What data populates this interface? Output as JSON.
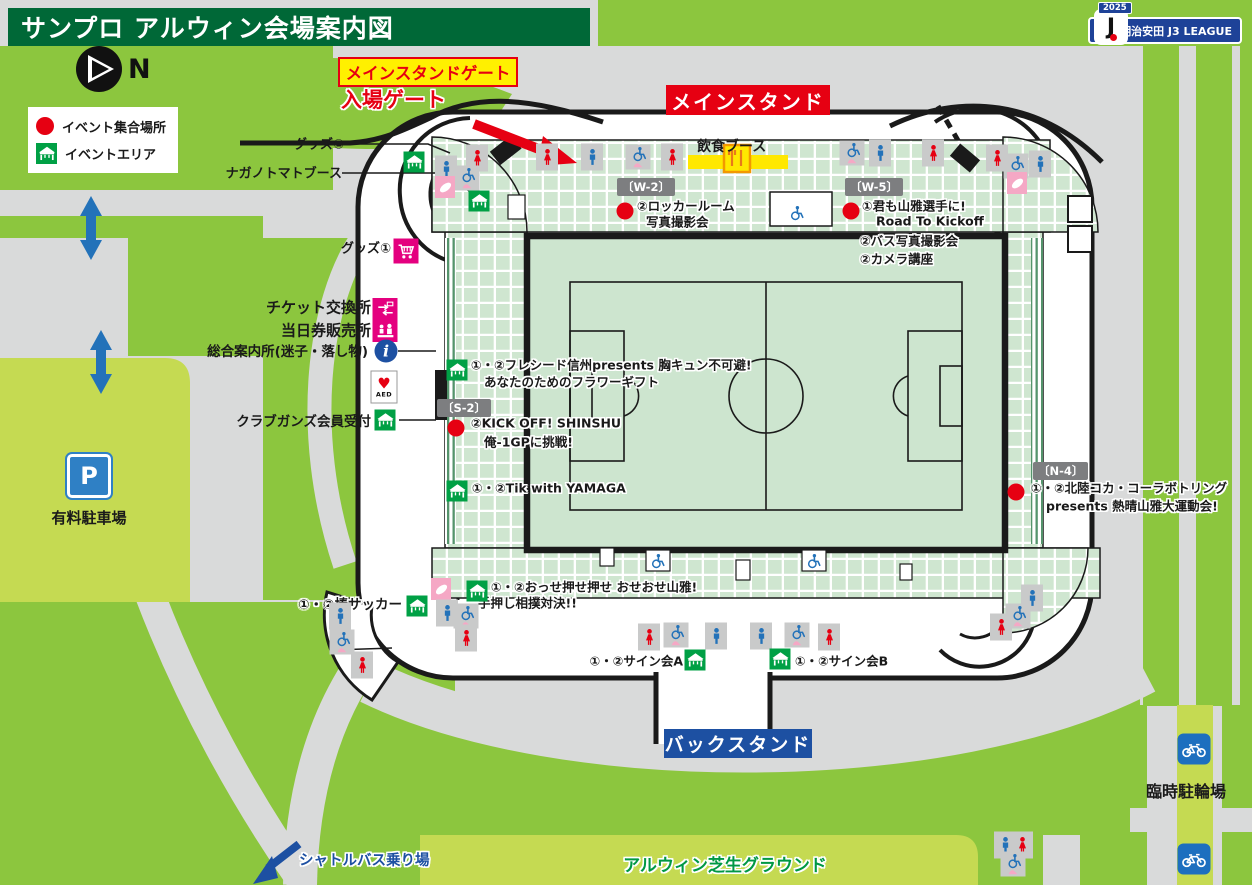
{
  "header": {
    "title": "サンプロ アルウィン会場案内図"
  },
  "league": {
    "year": "2025",
    "name": "明治安田 J3 LEAGUE",
    "crest": "J"
  },
  "compass": {
    "label": "N"
  },
  "legend": {
    "meeting_point": "イベント集合場所",
    "event_area": "イベントエリア"
  },
  "gates": {
    "main_stand_gate": "メインスタンドゲート",
    "entrance_gate": "入場ゲート"
  },
  "stands": {
    "main": "メインスタンド",
    "back": "バックスタンド"
  },
  "food": {
    "label": "飲食ブース"
  },
  "sections": {
    "w2": "〔W-2〕",
    "w5": "〔W-5〕",
    "s2": "〔S-2〕",
    "n4": "〔N-4〕"
  },
  "left_labels": {
    "goods2": "グッズ②",
    "nagano_tomato": "ナガノトマトブース",
    "goods1": "グッズ①",
    "ticket_exchange": "チケット交換所",
    "same_day_tickets": "当日券販売所",
    "info_center": "総合案内所(迷子・落し物)",
    "club_gahnz": "クラブガンズ会員受付"
  },
  "events": {
    "w2_line1": "②ロッカールーム",
    "w2_line2": "写真撮影会",
    "w5_line1": "①君も山雅選手に!",
    "w5_line2": "Road To Kickoff",
    "w5_line3": "②バス写真撮影会",
    "w5_line4": "②カメラ講座",
    "flower_line1": "①・②フレシード信州presents 胸キュン不可避!",
    "flower_line2": "あなたのためのフラワーギフト",
    "kickoff_line1": "②KICK OFF! SHINSHU",
    "kickoff_line2": "俺-1GPに挑戦!",
    "tik_line1": "①・②Tik with YAMAGA",
    "n4_line1": "①・②北陸コカ・コーラボトリング",
    "n4_line2": "presents 熱晴山雅大運動会!",
    "osse_line1": "①・②おっせ押せ押せ おせおせ山雅!",
    "osse_line2": "手押し相撲対決!!",
    "bou_soccer": "①・②棒サッカー",
    "sign_a": "①・②サイン会A",
    "sign_b": "①・②サイン会B"
  },
  "areas": {
    "paid_parking": "有料駐車場",
    "lawn_ground": "アルウィン芝生グラウンド",
    "temp_bicycle_parking": "臨時駐輪場",
    "shuttle_bus": "シャトルバス乗り場"
  },
  "colors": {
    "grass": "#8cc63e",
    "path_gray": "#d9dada",
    "accent_red": "#e60012",
    "label_blue": "#1d50a2",
    "header_green": "#006837",
    "highlight_yellow": "#fff000",
    "seat_green": "#cfe6d0",
    "lawn_green": "#c5da52",
    "icon_blue": "#2372b9",
    "icon_pink": "#e4007f",
    "tent_green": "#00a045",
    "nursing_pink": "#f5a8c5"
  },
  "icon_names": {
    "mens-toilet": "mens-toilet-icon",
    "womens-toilet": "womens-toilet-icon",
    "accessible-toilet": "accessible-toilet-icon",
    "wheelchair-seat": "wheelchair-seating-icon",
    "nursing-room": "nursing-room-icon",
    "event-tent": "event-area-tent-icon",
    "meeting-point": "event-meeting-point-icon",
    "goods-cart": "goods-shop-icon",
    "ticket-exchange": "ticket-exchange-icon",
    "ticket-sales": "ticket-sales-icon",
    "info-point": "information-icon",
    "aed": "aed-icon",
    "parking-sign": "parking-icon",
    "bicycle": "bicycle-parking-icon"
  },
  "markers": [
    {
      "type": "womens-toilet",
      "x": 547,
      "y": 157
    },
    {
      "type": "mens-toilet",
      "x": 592,
      "y": 157
    },
    {
      "type": "accessible-toilet",
      "x": 638,
      "y": 157
    },
    {
      "type": "womens-toilet",
      "x": 672,
      "y": 157
    },
    {
      "type": "accessible-toilet",
      "x": 852,
      "y": 153
    },
    {
      "type": "mens-toilet",
      "x": 880,
      "y": 153
    },
    {
      "type": "womens-toilet",
      "x": 933,
      "y": 153
    },
    {
      "type": "womens-toilet",
      "x": 997,
      "y": 158
    },
    {
      "type": "accessible-toilet",
      "x": 1016,
      "y": 166
    },
    {
      "type": "mens-toilet",
      "x": 1040,
      "y": 164
    },
    {
      "type": "nursing-room",
      "x": 1017,
      "y": 183
    },
    {
      "type": "event-tent",
      "x": 414,
      "y": 162
    },
    {
      "type": "womens-toilet",
      "x": 477,
      "y": 158
    },
    {
      "type": "mens-toilet",
      "x": 446,
      "y": 169
    },
    {
      "type": "accessible-toilet",
      "x": 467,
      "y": 178
    },
    {
      "type": "nursing-room",
      "x": 445,
      "y": 187
    },
    {
      "type": "event-tent",
      "x": 479,
      "y": 201
    },
    {
      "type": "goods-cart",
      "x": 406,
      "y": 251
    },
    {
      "type": "ticket-exchange",
      "x": 385,
      "y": 309
    },
    {
      "type": "ticket-sales",
      "x": 385,
      "y": 331
    },
    {
      "type": "info-point",
      "x": 386,
      "y": 351
    },
    {
      "type": "aed",
      "x": 384,
      "y": 387
    },
    {
      "type": "event-tent",
      "x": 385,
      "y": 420
    },
    {
      "type": "event-tent",
      "x": 457,
      "y": 370
    },
    {
      "type": "meeting-point",
      "x": 456,
      "y": 428
    },
    {
      "type": "event-tent",
      "x": 457,
      "y": 491
    },
    {
      "type": "meeting-point",
      "x": 625,
      "y": 211
    },
    {
      "type": "wheelchair-seat",
      "x": 796,
      "y": 213
    },
    {
      "type": "meeting-point",
      "x": 851,
      "y": 211
    },
    {
      "type": "meeting-point",
      "x": 1016,
      "y": 492
    },
    {
      "type": "wheelchair-seat",
      "x": 657,
      "y": 561
    },
    {
      "type": "wheelchair-seat",
      "x": 813,
      "y": 561
    },
    {
      "type": "womens-toilet",
      "x": 649,
      "y": 637
    },
    {
      "type": "accessible-toilet",
      "x": 676,
      "y": 635
    },
    {
      "type": "mens-toilet",
      "x": 716,
      "y": 636
    },
    {
      "type": "mens-toilet",
      "x": 761,
      "y": 636
    },
    {
      "type": "accessible-toilet",
      "x": 797,
      "y": 635
    },
    {
      "type": "womens-toilet",
      "x": 829,
      "y": 637
    },
    {
      "type": "event-tent",
      "x": 695,
      "y": 660
    },
    {
      "type": "event-tent",
      "x": 780,
      "y": 659
    },
    {
      "type": "nursing-room",
      "x": 441,
      "y": 589
    },
    {
      "type": "event-tent",
      "x": 477,
      "y": 591
    },
    {
      "type": "mens-toilet",
      "x": 447,
      "y": 613
    },
    {
      "type": "accessible-toilet",
      "x": 466,
      "y": 616
    },
    {
      "type": "womens-toilet",
      "x": 466,
      "y": 638
    },
    {
      "type": "event-tent",
      "x": 417,
      "y": 606
    },
    {
      "type": "mens-toilet",
      "x": 340,
      "y": 616
    },
    {
      "type": "accessible-toilet",
      "x": 342,
      "y": 642
    },
    {
      "type": "womens-toilet",
      "x": 362,
      "y": 665
    },
    {
      "type": "mens-toilet",
      "x": 1032,
      "y": 598
    },
    {
      "type": "accessible-toilet",
      "x": 1018,
      "y": 616
    },
    {
      "type": "womens-toilet",
      "x": 1001,
      "y": 627
    },
    {
      "type": "mens-toilet",
      "x": 1005,
      "y": 845
    },
    {
      "type": "womens-toilet",
      "x": 1022,
      "y": 845
    },
    {
      "type": "accessible-toilet",
      "x": 1013,
      "y": 864
    },
    {
      "type": "parking-sign",
      "x": 89,
      "y": 476
    },
    {
      "type": "bicycle",
      "x": 1194,
      "y": 749
    },
    {
      "type": "bicycle",
      "x": 1194,
      "y": 859
    }
  ]
}
